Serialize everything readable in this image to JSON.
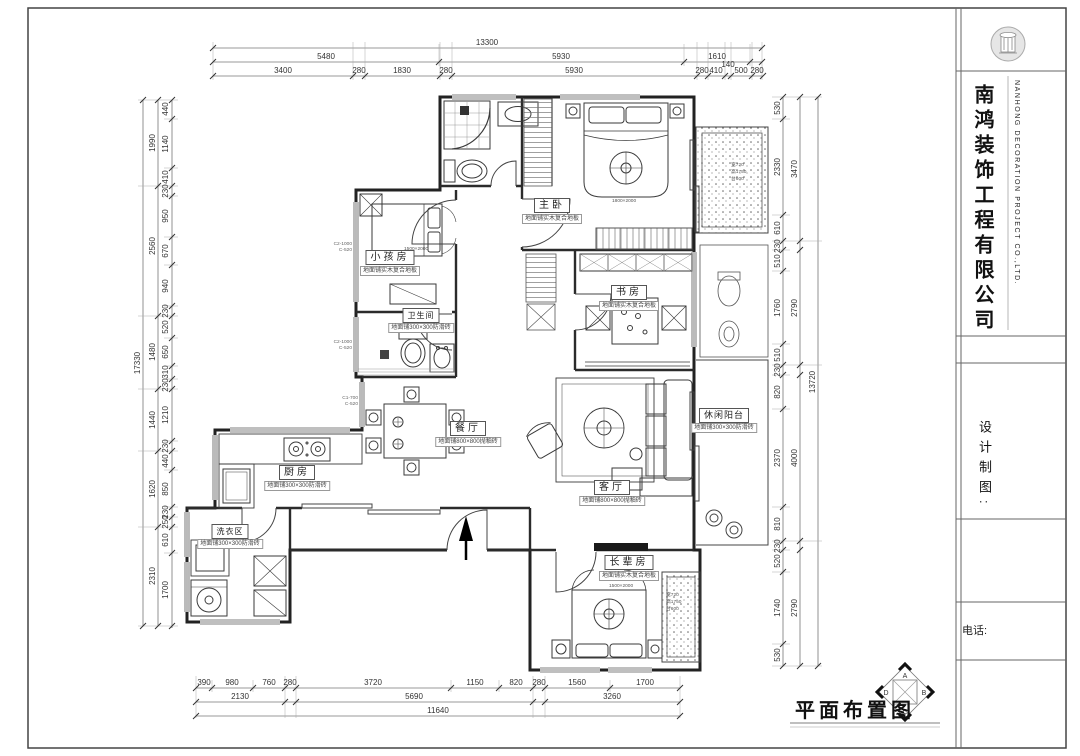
{
  "title_block": {
    "company_cn": "南鸿装饰工程有限公司",
    "company_en": "NANHONG DECORATION PROJECT CO.,LTD.",
    "design_label": "设计制图:",
    "phone_label": "电话:"
  },
  "sheet": {
    "title": "平面布置图"
  },
  "compass": {
    "a": "A",
    "b": "B",
    "c": "C",
    "d": "D"
  },
  "rooms": [
    {
      "name": "主卧",
      "note": "地面铺实木复合地板"
    },
    {
      "name": "小孩房",
      "note": "地面铺实木复合地板"
    },
    {
      "name": "书房",
      "note": "地面铺实木复合地板"
    },
    {
      "name": "餐厅",
      "note": "地面铺800×800抛釉砖"
    },
    {
      "name": "客厅",
      "note": "地面铺800×800抛釉砖"
    },
    {
      "name": "厨房",
      "note": "地面铺300×300防滑砖"
    },
    {
      "name": "洗衣区",
      "note": "地面铺300×300防滑砖"
    },
    {
      "name": "长辈房",
      "note": "地面铺实木复合地板"
    },
    {
      "name": "休闲阳台",
      "note": "地面铺300×300防滑砖"
    },
    {
      "name": "卫生间",
      "note": "地面铺300×300防滑砖"
    }
  ],
  "furniture_notes": {
    "bed_master": "1800×2000",
    "bed_kids": "1500×2000",
    "bed_elder": "1500×2000"
  },
  "window_spec": [
    "宽720",
    "高1750",
    "台600"
  ],
  "window_tags": [
    [
      "C2-1000",
      "C-520"
    ],
    [
      "C2-1000",
      "C-520"
    ],
    [
      "C1-700",
      "C-520"
    ]
  ],
  "dims": {
    "top1": [
      "13300"
    ],
    "top2": [
      "5480",
      "5930",
      "1610"
    ],
    "top3": [
      "3400",
      "280",
      "1830",
      "280",
      "5930",
      "280",
      "410",
      "140",
      "500",
      "280"
    ],
    "bot1": [
      "390",
      "980",
      "760",
      "280",
      "3720",
      "1150",
      "820",
      "280",
      "1560",
      "1700"
    ],
    "bot2": [
      "2130",
      "5690",
      "3260"
    ],
    "bot3": [
      "11640"
    ],
    "left_outer": [
      "17330"
    ],
    "left_mid": [
      "1990",
      "2560",
      "1480",
      "1440",
      "1620",
      "2310"
    ],
    "left_inner": [
      "440",
      "1140",
      "410",
      "230",
      "950",
      "670",
      "940",
      "230",
      "520",
      "650",
      "310",
      "230",
      "1210",
      "230",
      "440",
      "850",
      "230",
      "250",
      "610",
      "1700"
    ],
    "right_outer": [
      "13720"
    ],
    "right_mid": [
      "3470",
      "2790",
      "4000",
      "2790"
    ],
    "right_inner": [
      "530",
      "2330",
      "610",
      "230",
      "510",
      "1760",
      "510",
      "230",
      "820",
      "2370",
      "810",
      "230",
      "520",
      "1740",
      "530"
    ]
  }
}
